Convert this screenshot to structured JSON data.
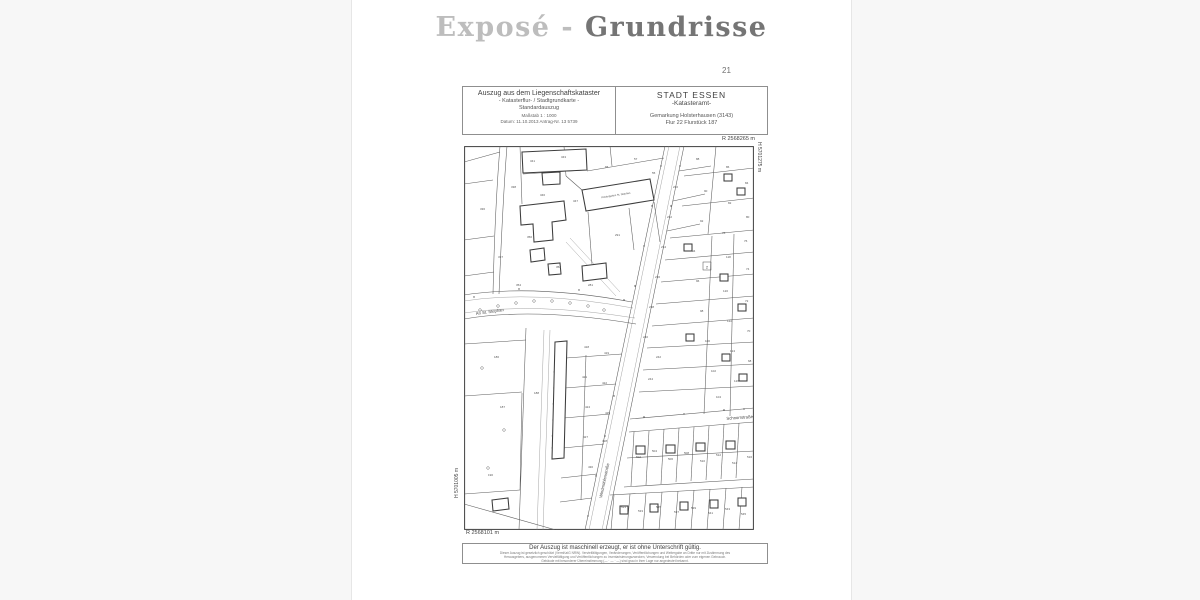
{
  "page": {
    "title_light": "Exposé - ",
    "title_dark": "Grundrisse",
    "page_number": "21"
  },
  "document": {
    "header_left": {
      "line1": "Auszug aus dem Liegenschaftskataster",
      "line2": "- Katasterflur- / Stadtgrundkarte -",
      "line3": "Standardauszug",
      "line4": "Maßstab 1 : 1000",
      "line5": "Datum: 11.10.2013    Antrag-Nr. 13 5739"
    },
    "header_right": {
      "line1": "STADT ESSEN",
      "line2": "-Katasteramt-",
      "line3": "Gemarkung Holsterhausen (3143)",
      "line4": "Flur 22    Flurstück 187"
    },
    "coordinates": {
      "top_right": "R 2568265 m",
      "right_vertical": "H 5701275 m",
      "left_vertical": "H 5701005 m",
      "bottom_left": "R 2568101 m"
    },
    "map": {
      "street_an_st_stephan": "An St. Stephan",
      "street_schnorrstrasse": "Schnorrstraße",
      "street_windmuehlenstrasse": "Windmühlenstraße",
      "building_label": "Kindergarten St. Stephan",
      "boxed_symbol": "2",
      "parcel_numbers": [
        {
          "x": 66,
          "y": 16,
          "v": "341"
        },
        {
          "x": 97,
          "y": 12,
          "v": "343"
        },
        {
          "x": 141,
          "y": 22,
          "v": "65"
        },
        {
          "x": 170,
          "y": 14,
          "v": "57"
        },
        {
          "x": 188,
          "y": 28,
          "v": "55"
        },
        {
          "x": 47,
          "y": 42,
          "v": "338"
        },
        {
          "x": 76,
          "y": 50,
          "v": "346"
        },
        {
          "x": 109,
          "y": 56,
          "v": "347"
        },
        {
          "x": 151,
          "y": 90,
          "v": "291"
        },
        {
          "x": 63,
          "y": 92,
          "v": "350"
        },
        {
          "x": 34,
          "y": 112,
          "v": "337"
        },
        {
          "x": 92,
          "y": 122,
          "v": "352"
        },
        {
          "x": 124,
          "y": 140,
          "v": "281"
        },
        {
          "x": 52,
          "y": 140,
          "v": "354"
        },
        {
          "x": 16,
          "y": 64,
          "v": "336"
        },
        {
          "x": 232,
          "y": 14,
          "v": "88"
        },
        {
          "x": 262,
          "y": 22,
          "v": "86"
        },
        {
          "x": 281,
          "y": 38,
          "v": "84"
        },
        {
          "x": 240,
          "y": 46,
          "v": "90"
        },
        {
          "x": 264,
          "y": 58,
          "v": "82"
        },
        {
          "x": 282,
          "y": 72,
          "v": "80"
        },
        {
          "x": 236,
          "y": 76,
          "v": "92"
        },
        {
          "x": 258,
          "y": 88,
          "v": "78"
        },
        {
          "x": 280,
          "y": 96,
          "v": "76"
        },
        {
          "x": 228,
          "y": 106,
          "v": "94"
        },
        {
          "x": 262,
          "y": 112,
          "v": "118"
        },
        {
          "x": 282,
          "y": 124,
          "v": "74"
        },
        {
          "x": 232,
          "y": 136,
          "v": "96"
        },
        {
          "x": 259,
          "y": 146,
          "v": "120"
        },
        {
          "x": 281,
          "y": 156,
          "v": "72"
        },
        {
          "x": 236,
          "y": 166,
          "v": "98"
        },
        {
          "x": 263,
          "y": 176,
          "v": "122"
        },
        {
          "x": 283,
          "y": 186,
          "v": "70"
        },
        {
          "x": 241,
          "y": 196,
          "v": "100"
        },
        {
          "x": 266,
          "y": 206,
          "v": "124"
        },
        {
          "x": 284,
          "y": 216,
          "v": "68"
        },
        {
          "x": 247,
          "y": 226,
          "v": "102"
        },
        {
          "x": 270,
          "y": 236,
          "v": "126"
        },
        {
          "x": 252,
          "y": 252,
          "v": "104"
        },
        {
          "x": 209,
          "y": 42,
          "v": "230"
        },
        {
          "x": 203,
          "y": 72,
          "v": "232"
        },
        {
          "x": 197,
          "y": 102,
          "v": "234"
        },
        {
          "x": 191,
          "y": 132,
          "v": "236"
        },
        {
          "x": 185,
          "y": 162,
          "v": "238"
        },
        {
          "x": 179,
          "y": 192,
          "v": "240"
        },
        {
          "x": 192,
          "y": 212,
          "v": "242"
        },
        {
          "x": 184,
          "y": 234,
          "v": "244"
        },
        {
          "x": 120,
          "y": 202,
          "v": "418"
        },
        {
          "x": 140,
          "y": 208,
          "v": "419"
        },
        {
          "x": 118,
          "y": 232,
          "v": "421"
        },
        {
          "x": 138,
          "y": 238,
          "v": "422"
        },
        {
          "x": 121,
          "y": 262,
          "v": "424"
        },
        {
          "x": 141,
          "y": 268,
          "v": "425"
        },
        {
          "x": 119,
          "y": 292,
          "v": "427"
        },
        {
          "x": 138,
          "y": 296,
          "v": "428"
        },
        {
          "x": 124,
          "y": 322,
          "v": "430"
        },
        {
          "x": 36,
          "y": 262,
          "v": "187"
        },
        {
          "x": 30,
          "y": 212,
          "v": "186"
        },
        {
          "x": 70,
          "y": 248,
          "v": "188"
        },
        {
          "x": 24,
          "y": 330,
          "v": "190"
        },
        {
          "x": 172,
          "y": 312,
          "v": "502"
        },
        {
          "x": 188,
          "y": 306,
          "v": "504"
        },
        {
          "x": 204,
          "y": 314,
          "v": "506"
        },
        {
          "x": 220,
          "y": 308,
          "v": "508"
        },
        {
          "x": 236,
          "y": 316,
          "v": "510"
        },
        {
          "x": 252,
          "y": 310,
          "v": "512"
        },
        {
          "x": 268,
          "y": 318,
          "v": "514"
        },
        {
          "x": 283,
          "y": 312,
          "v": "516"
        },
        {
          "x": 157,
          "y": 362,
          "v": "531"
        },
        {
          "x": 174,
          "y": 366,
          "v": "533"
        },
        {
          "x": 192,
          "y": 362,
          "v": "535"
        },
        {
          "x": 210,
          "y": 367,
          "v": "537"
        },
        {
          "x": 227,
          "y": 363,
          "v": "539"
        },
        {
          "x": 244,
          "y": 368,
          "v": "541"
        },
        {
          "x": 261,
          "y": 364,
          "v": "543"
        },
        {
          "x": 277,
          "y": 369,
          "v": "545"
        }
      ]
    },
    "footer": {
      "line1": "Der Auszug ist maschinell erzeugt, er ist ohne Unterschrift gültig.",
      "fineprint1": "Dieser Auszug ist gesetzlich geschützt (VermKatG NRW). Vervielfältigungen, Veränderungen, Veröffentlichungen und Weitergabe an Dritte nur mit Zustimmung des",
      "fineprint2": "Herausgebers, ausgenommen Vervielfältigung und Veröffentlichungen zu Inventarisierungszwecken, Verwendung bei Behörden oder zum eigenen Gebrauch.",
      "fineprint3": "Gebäude mit besonderer Übereinstimmung (— · — · —) sind grau in ihrer Lage nur angedeutet bekannt."
    }
  }
}
